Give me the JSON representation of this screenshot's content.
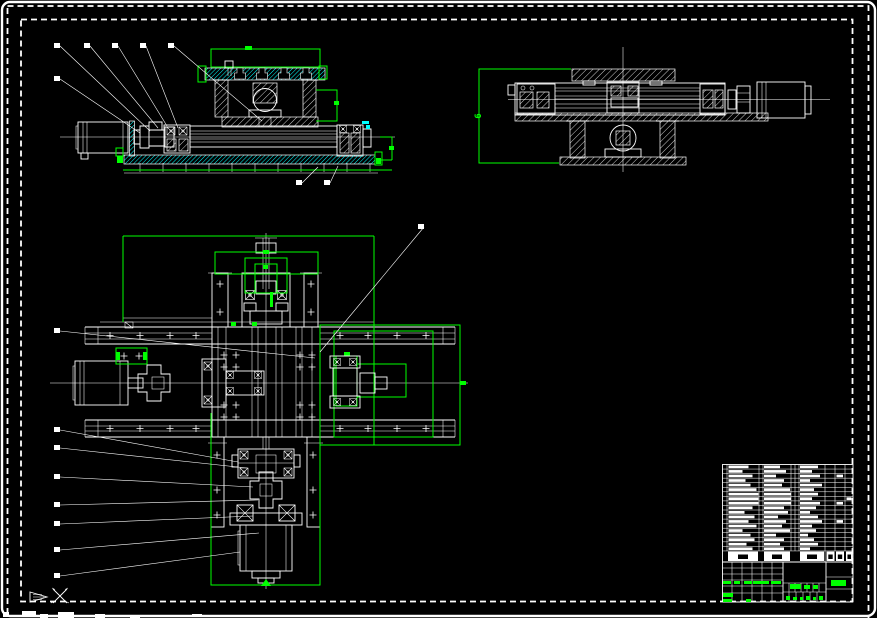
{
  "app": {
    "type": "cad-model-space",
    "background": "#000000",
    "colors": {
      "lines": "#ffffff",
      "dimensions": "#00ff00",
      "hatch_accent": "#00ffff"
    }
  },
  "views": {
    "front": {
      "label": "front-section-view",
      "leaders": [
        [
          57,
          46,
          150,
          131
        ],
        [
          87,
          46,
          158,
          128
        ],
        [
          115,
          46,
          167,
          126
        ],
        [
          143,
          46,
          178,
          128
        ],
        [
          171,
          46,
          262,
          121
        ],
        [
          57,
          79,
          140,
          133
        ],
        [
          299,
          183,
          318,
          167
        ],
        [
          327,
          183,
          338,
          166
        ]
      ]
    },
    "side": {
      "label": "side-section-view",
      "dim_label": "6",
      "leaders": []
    },
    "plan": {
      "label": "plan-view",
      "leaders": [
        [
          57,
          331,
          315,
          358
        ],
        [
          57,
          430,
          238,
          462
        ],
        [
          57,
          448,
          247,
          468
        ],
        [
          57,
          477,
          253,
          487
        ],
        [
          57,
          505,
          258,
          500
        ],
        [
          57,
          524,
          253,
          516
        ],
        [
          57,
          550,
          259,
          533
        ],
        [
          57,
          576,
          240,
          552
        ],
        [
          421,
          227,
          320,
          352
        ]
      ]
    }
  },
  "parts_table": {
    "x": 722.5,
    "y": 464.5,
    "row_height": 4.55,
    "rows": [
      {
        "a": 20,
        "b": 16,
        "c": 18,
        "d": 0,
        "e": 0
      },
      {
        "a": 14,
        "b": 22,
        "c": 12,
        "d": 0,
        "e": 0
      },
      {
        "a": 24,
        "b": 12,
        "c": 20,
        "d": 1,
        "e": 0
      },
      {
        "a": 17,
        "b": 20,
        "c": 10,
        "d": 0,
        "e": 0
      },
      {
        "a": 22,
        "b": 18,
        "c": 22,
        "d": 0,
        "e": 0
      },
      {
        "a": 28,
        "b": 26,
        "c": 14,
        "d": 0,
        "e": 0
      },
      {
        "a": 30,
        "b": 27,
        "c": 18,
        "d": 0,
        "e": 0
      },
      {
        "a": 30,
        "b": 27,
        "c": 12,
        "d": 0,
        "e": 1
      },
      {
        "a": 30,
        "b": 27,
        "c": 20,
        "d": 1,
        "e": 0
      },
      {
        "a": 24,
        "b": 20,
        "c": 16,
        "d": 0,
        "e": 0
      },
      {
        "a": 16,
        "b": 24,
        "c": 10,
        "d": 0,
        "e": 0
      },
      {
        "a": 26,
        "b": 14,
        "c": 18,
        "d": 0,
        "e": 0
      },
      {
        "a": 20,
        "b": 22,
        "c": 22,
        "d": 1,
        "e": 0
      },
      {
        "a": 28,
        "b": 18,
        "c": 12,
        "d": 0,
        "e": 0
      },
      {
        "a": 14,
        "b": 26,
        "c": 16,
        "d": 0,
        "e": 0
      },
      {
        "a": 22,
        "b": 12,
        "c": 8,
        "d": 0,
        "e": 0
      },
      {
        "a": 26,
        "b": 20,
        "c": 14,
        "d": 0,
        "e": 0
      },
      {
        "a": 18,
        "b": 16,
        "c": 18,
        "d": 0,
        "e": 0
      },
      {
        "a": 24,
        "b": 20,
        "c": 10,
        "d": 0,
        "e": 0
      }
    ],
    "header_cells": [
      {
        "x": 728,
        "w": 30
      },
      {
        "x": 764,
        "w": 26
      },
      {
        "x": 800,
        "w": 24
      },
      {
        "x": 826.5,
        "w": 8
      },
      {
        "x": 836,
        "w": 8
      },
      {
        "x": 846,
        "w": 6.5
      }
    ]
  },
  "title_block": {
    "green_marks": [
      [
        723,
        581,
        8,
        3
      ],
      [
        734,
        581,
        6,
        3
      ],
      [
        744,
        581,
        8,
        3
      ],
      [
        753,
        581,
        16,
        3
      ],
      [
        771,
        581,
        10,
        3
      ],
      [
        723,
        593,
        10,
        4
      ],
      [
        723,
        599,
        9,
        3
      ],
      [
        746,
        599,
        5,
        3
      ],
      [
        790,
        584,
        11,
        5
      ],
      [
        804,
        585,
        6,
        4
      ],
      [
        813,
        585,
        5,
        4
      ],
      [
        786,
        596,
        4,
        4
      ],
      [
        793,
        597,
        4,
        3
      ],
      [
        800,
        597,
        3,
        3
      ],
      [
        806,
        596,
        4,
        4
      ],
      [
        813,
        597,
        3,
        3
      ],
      [
        819,
        596,
        4,
        4
      ],
      [
        831,
        580,
        15,
        6
      ]
    ]
  },
  "bottom_fragments": [
    [
      3,
      612,
      6,
      5
    ],
    [
      22,
      611,
      14,
      6
    ],
    [
      40,
      614,
      8,
      4
    ],
    [
      58,
      612,
      16,
      6
    ],
    [
      95,
      614,
      10,
      4
    ],
    [
      130,
      615,
      10,
      3
    ],
    [
      192,
      614,
      10,
      3
    ]
  ]
}
